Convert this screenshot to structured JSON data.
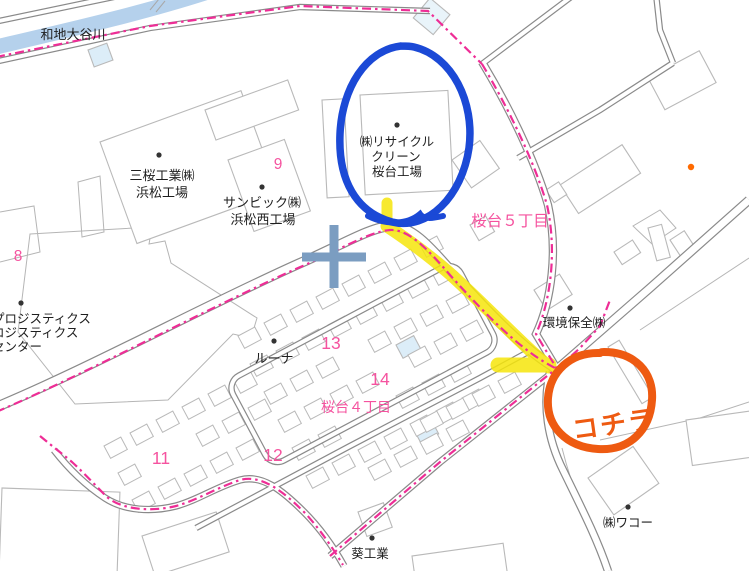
{
  "map": {
    "river_label": "和地大谷川",
    "district_labels": {
      "sakuradai5": "桜台５丁目",
      "sakuradai4": "桜台４丁目"
    },
    "block_numbers": {
      "b8": "8",
      "b9": "9",
      "b11": "11",
      "b12": "12",
      "b13": "13",
      "b14": "14"
    },
    "pois": {
      "sanoh_line1": "三桜工業㈱",
      "sanoh_line2": "浜松工場",
      "sunbic_line1": "サンビック㈱",
      "sunbic_line2": "浜松西工場",
      "recycle_line1": "㈱リサイクル",
      "recycle_line2": "クリーン",
      "recycle_line3": "桜台工場",
      "kankyo": "環境保全㈱",
      "luna": "ルーナ",
      "logistics_line1": "プロジスティクス",
      "logistics_line2": "ロジスティクス",
      "logistics_line3": "センター",
      "aoi": "葵工業",
      "wako": "㈱ワコー"
    },
    "colors": {
      "river": "#b5d1ec",
      "boundary_pink": "#ee2d96",
      "district_pink": "#f5539f",
      "road_gray": "#8a8a8a",
      "building_gray": "#b9b9b9",
      "poi_orange": "#ff6a00"
    }
  },
  "annotations": {
    "kochira_label": "コチラ",
    "colors": {
      "blue_circle": "#1b49d6",
      "orange": "#ee5a11",
      "yellow_highlight": "#f6e60b",
      "cross_blue": "#7b9dc1"
    }
  }
}
